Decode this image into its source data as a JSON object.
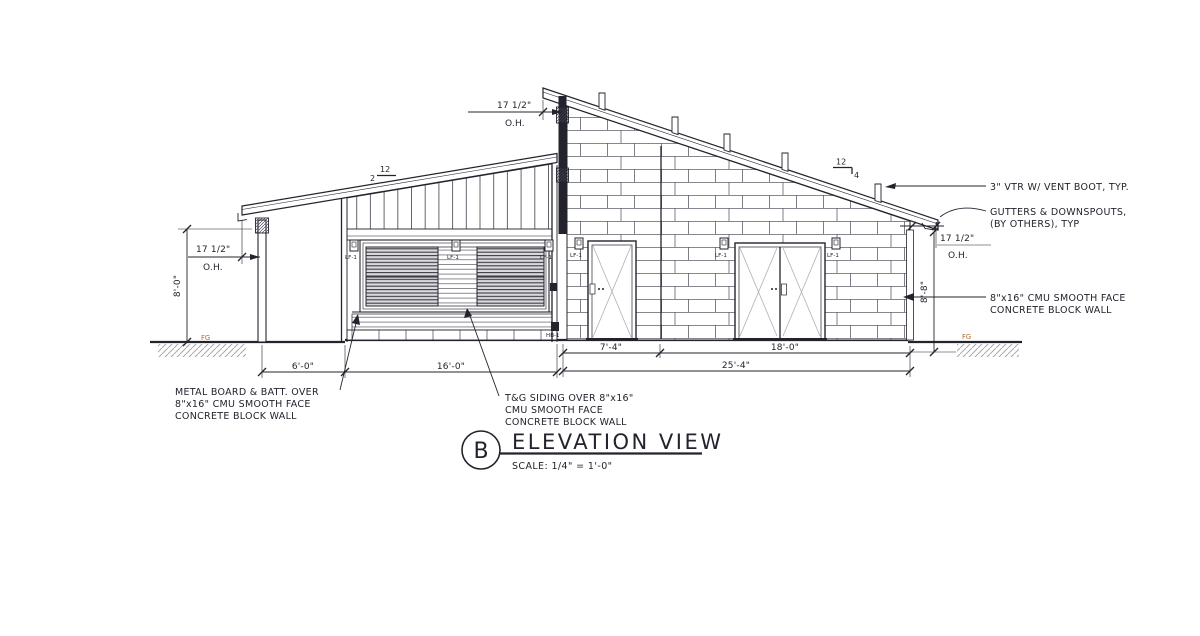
{
  "titleblock": {
    "detail_letter": "B",
    "title": "ELEVATION VIEW",
    "scale": "SCALE: 1/4\" = 1'-0\""
  },
  "dimensions": {
    "oh_top": "17 1/2\"",
    "oh_top_label": "O.H.",
    "oh_left": "17 1/2\"",
    "oh_left_label": "O.H.",
    "oh_right": "17 1/2\"",
    "oh_right_label": "O.H.",
    "height_left": "8'-0\"",
    "height_right": "8'-8\"",
    "porch": "6'-0\"",
    "mid": "16'-0\"",
    "bay_door": "7'-4\"",
    "bay_garage": "18'-0\"",
    "total_right": "25'-4\""
  },
  "slopes": {
    "left_run": "12",
    "left_rise": "2",
    "right_run": "12",
    "right_rise": "4"
  },
  "notes": {
    "vent": "3\" VTR W/ VENT BOOT, TYP.",
    "gutters_line1": "GUTTERS & DOWNSPOUTS,",
    "gutters_line2": "(BY OTHERS), TYP",
    "cmu_line1": "8\"x16\" CMU SMOOTH FACE",
    "cmu_line2": "CONCRETE BLOCK WALL",
    "metal_line1": "METAL BOARD & BATT. OVER",
    "metal_line2": "8\"x16\" CMU SMOOTH FACE",
    "metal_line3": "CONCRETE BLOCK WALL",
    "tg_line1": "T&G SIDING OVER 8\"x16\"",
    "tg_line2": "CMU SMOOTH FACE",
    "tg_line3": "CONCRETE BLOCK WALL"
  },
  "tags": {
    "light_fixture": "LF-1",
    "hose_bib": "HB-1",
    "finish_grade": "FG"
  },
  "colors": {
    "line": "#23232e",
    "fg_label": "#b06a28"
  }
}
